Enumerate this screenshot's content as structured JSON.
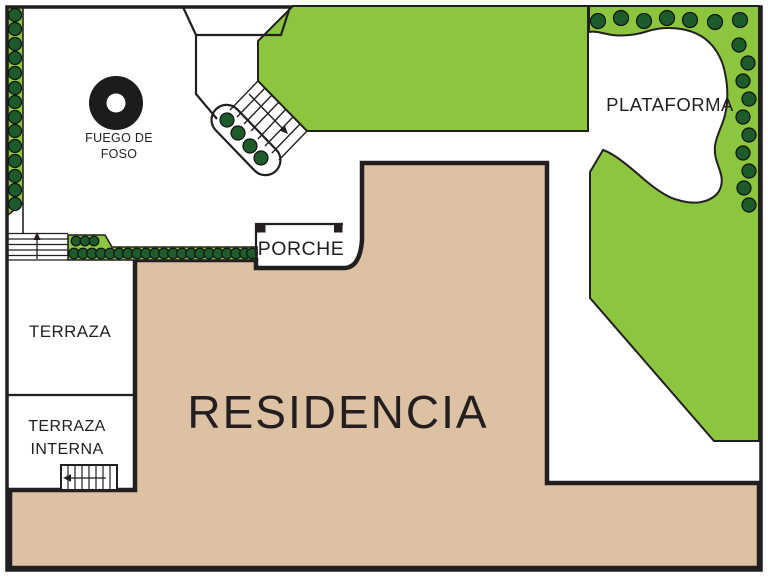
{
  "labels": {
    "residence": "RESIDENCIA",
    "platform": "PLATAFORMA",
    "porch": "PORCHE",
    "terrace": "TERRAZA",
    "inner_terrace_line1": "TERRAZA",
    "inner_terrace_line2": "INTERNA",
    "fire_pit_line1": "FUEGO DE",
    "fire_pit_line2": "FOSO"
  },
  "colors": {
    "lawn": "#8cc63f",
    "shrub": "#1e5b2b",
    "residence": "#dcc1a2",
    "outline": "#231f20",
    "fire_pit": "#1c1c1c",
    "background": "#ffffff"
  }
}
